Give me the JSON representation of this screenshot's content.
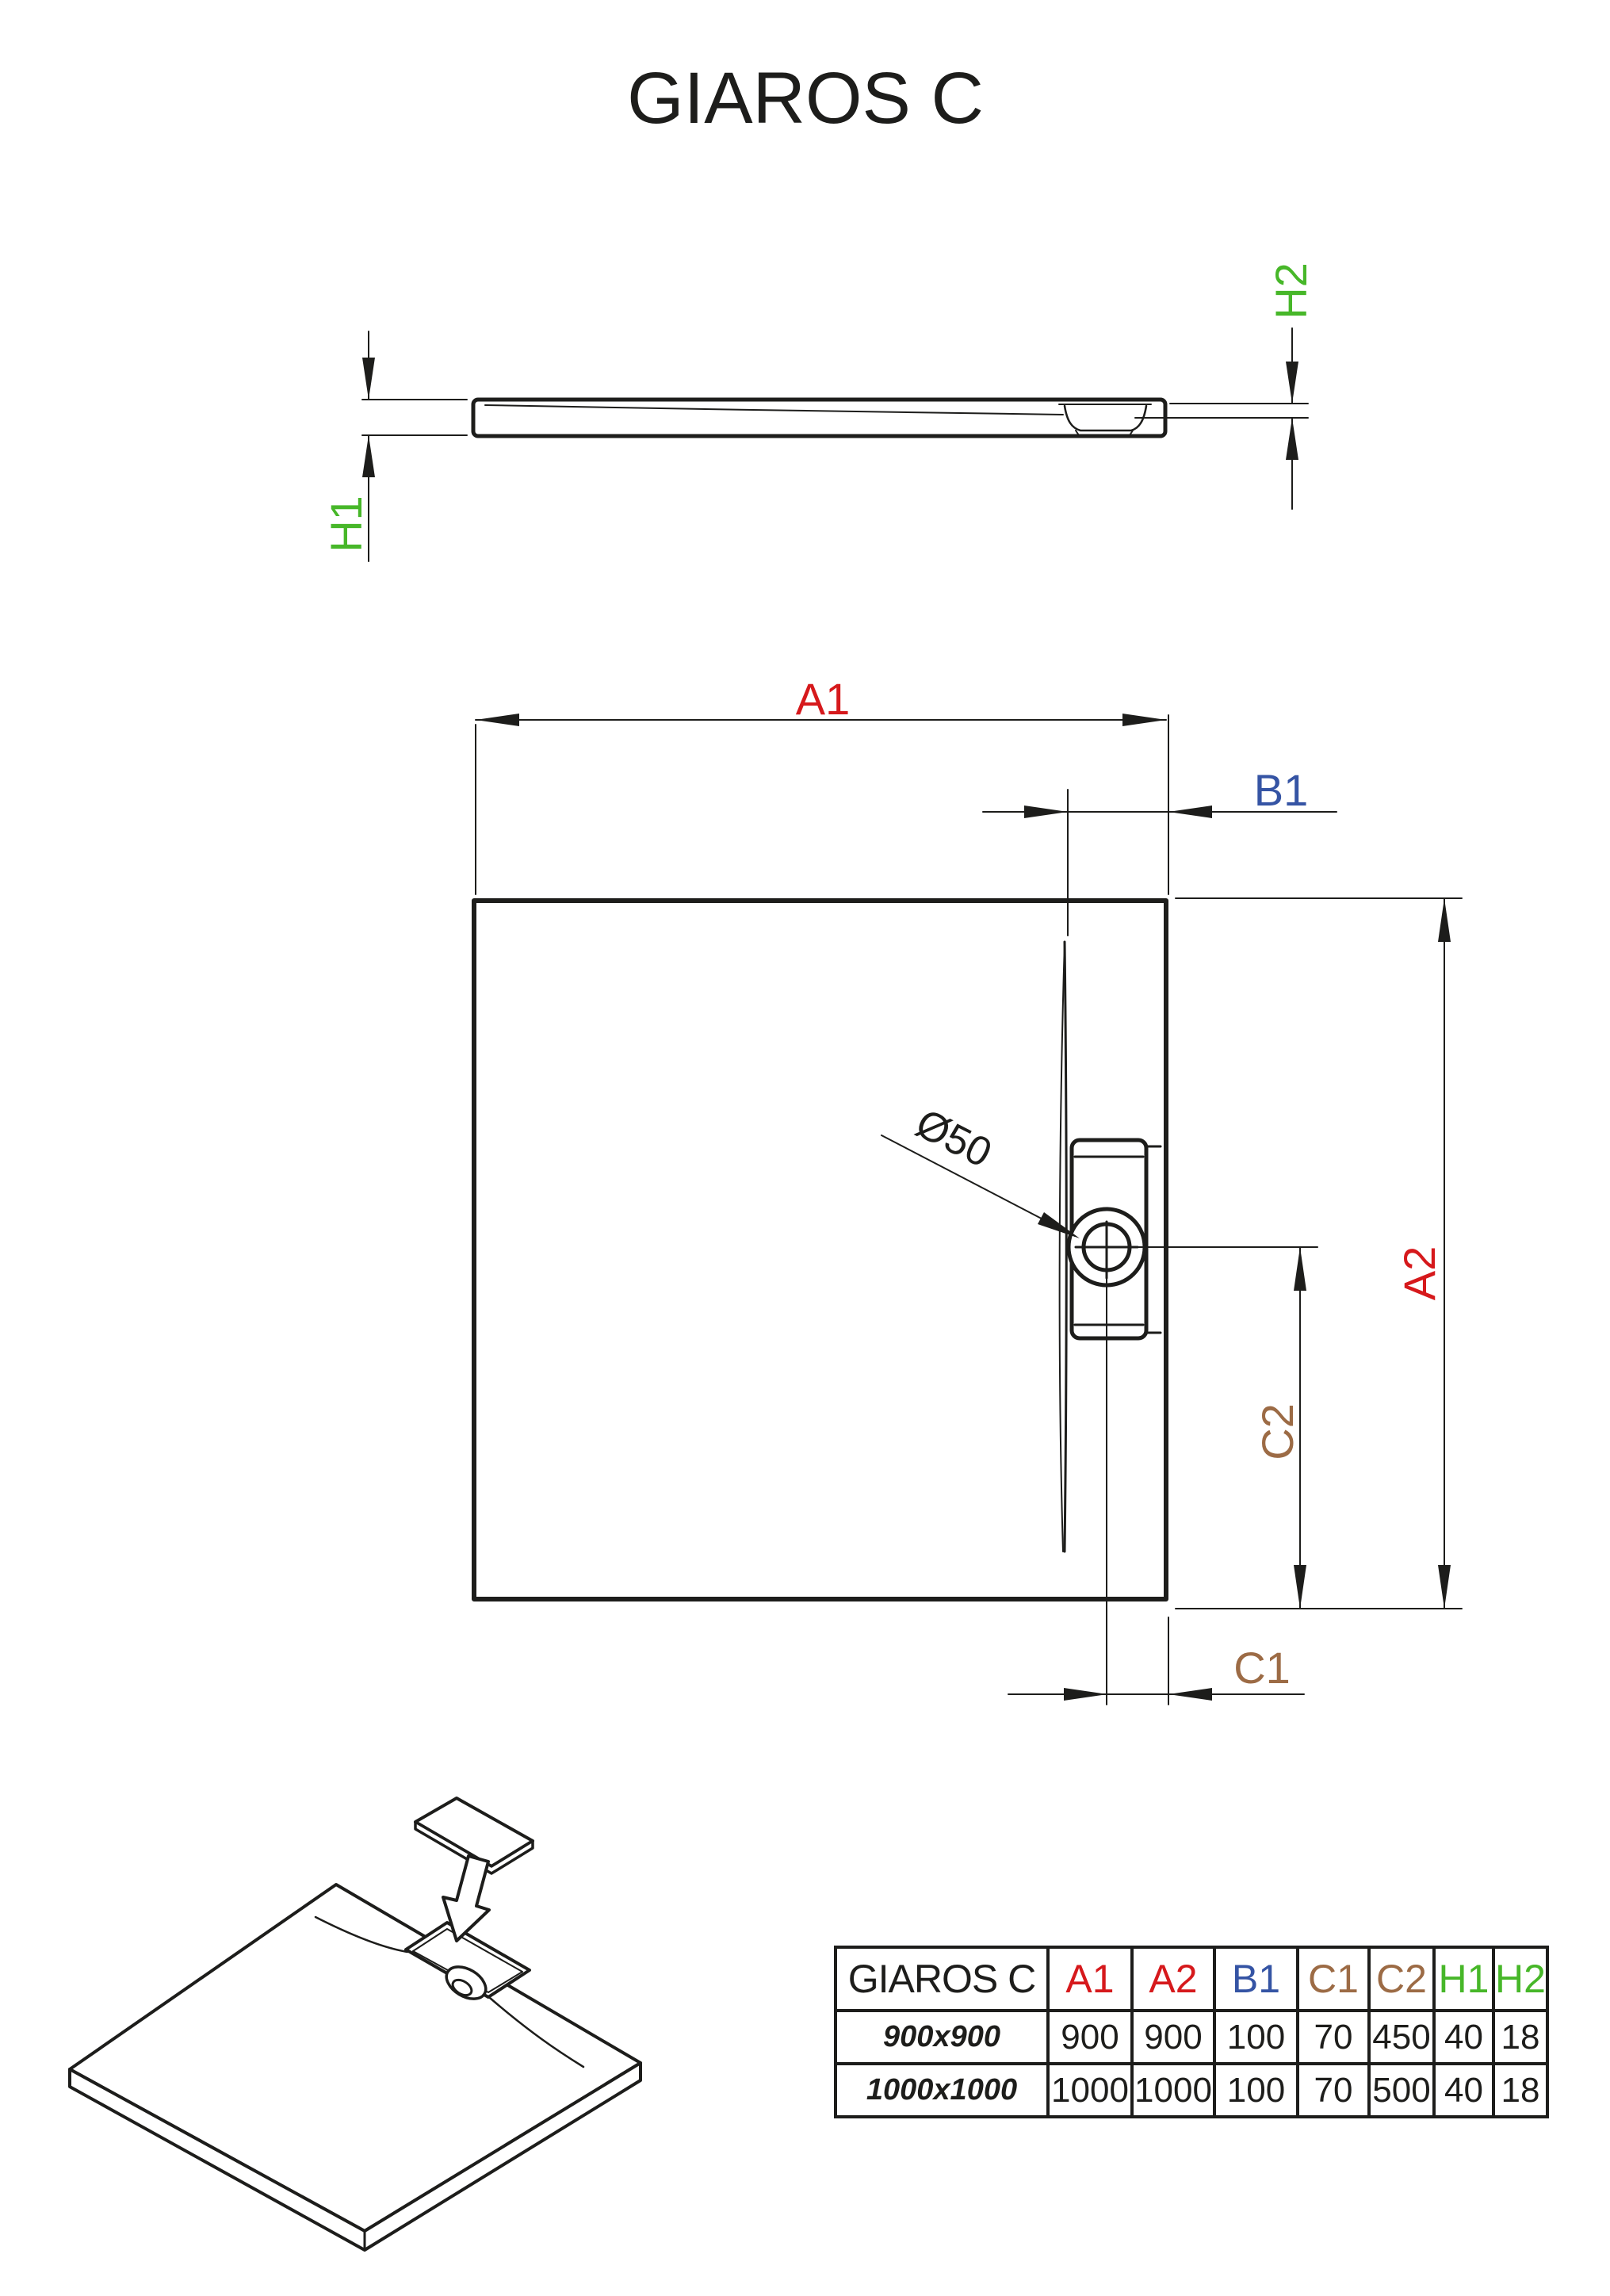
{
  "title": "GIAROS C",
  "drain_annotation": {
    "label": "Ø50",
    "color": "#1d1d1b"
  },
  "dims": {
    "a1": {
      "label": "A1",
      "color": "#d6191c"
    },
    "a2": {
      "label": "A2",
      "color": "#d6191c"
    },
    "b1": {
      "label": "B1",
      "color": "#3554a4"
    },
    "c1": {
      "label": "C1",
      "color": "#9c6b45"
    },
    "c2": {
      "label": "C2",
      "color": "#9c6b45"
    },
    "h1": {
      "label": "H1",
      "color": "#47b729"
    },
    "h2": {
      "label": "H2",
      "color": "#47b729"
    }
  },
  "table": {
    "product_label": "GIAROS C",
    "rows": [
      {
        "size": "900x900",
        "values": [
          "900",
          "900",
          "100",
          "70",
          "450",
          "40",
          "18"
        ]
      },
      {
        "size": "1000x1000",
        "values": [
          "1000",
          "1000",
          "100",
          "70",
          "500",
          "40",
          "18"
        ]
      }
    ]
  }
}
